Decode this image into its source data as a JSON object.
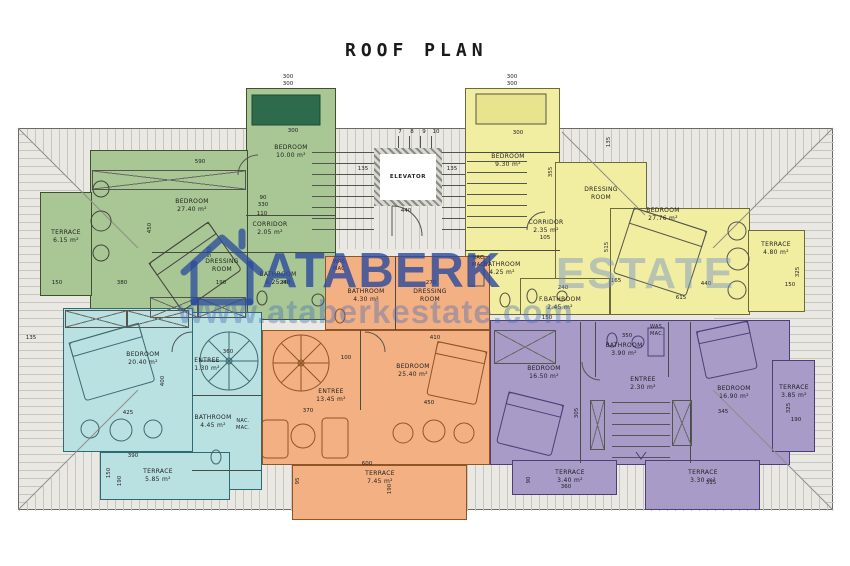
{
  "title": "ROOF PLAN",
  "watermark": {
    "brand": "ATABERK",
    "suffix": "ESTATE",
    "url": "www.ataberkestate.com"
  },
  "core": {
    "elevator": "ELEVATOR",
    "stairs": [
      "7",
      "8",
      "9",
      "10"
    ],
    "dims": {
      "l135": "135",
      "r135": "135",
      "w440": "440"
    }
  },
  "roof": {
    "dims": {
      "l135": "135"
    }
  },
  "units": {
    "green": {
      "rooms": {
        "terrace": {
          "name": "TERRACE",
          "area": "6.15 m²"
        },
        "bedroom_main": {
          "name": "BEDROOM",
          "area": "27.40 m²"
        },
        "bedroom_top": {
          "name": "BEDROOM",
          "area": "10.00 m²"
        },
        "dressing": {
          "name": "DRESSING ROOM",
          "area": ""
        },
        "corridor": {
          "name": "CORRIDOR",
          "area": "2.05 m²"
        },
        "bathroom": {
          "name": "BATHROOM",
          "area": "6.25 m²"
        }
      },
      "dims": {
        "d590": "590",
        "top300a": "300",
        "top300b": "300",
        "bed300": "300",
        "d450": "450",
        "d530": "530",
        "d110": "110",
        "d150": "150",
        "d380": "380",
        "d190": "190",
        "d240": "240",
        "d90": "90",
        "d330": "330"
      }
    },
    "yellow": {
      "rooms": {
        "bedroom_top": {
          "name": "BEDROOM",
          "area": "9.30 m²"
        },
        "dressing": {
          "name": "DRESSING ROOM",
          "area": ""
        },
        "corridor": {
          "name": "CORRIDOR",
          "area": "2.35 m²"
        },
        "bathroom": {
          "name": "BATHROOM",
          "area": "4.25 m²"
        },
        "wash": {
          "name": "NAC. MAC.",
          "area": ""
        },
        "f_bathroom": {
          "name": "F.BATHROOM",
          "area": "2.45 m²"
        },
        "bedroom_main": {
          "name": "BEDROOM",
          "area": "27.76 m²"
        },
        "terrace": {
          "name": "TERRACE",
          "area": "4.80 m²"
        }
      },
      "dims": {
        "top300a": "300",
        "top300b": "300",
        "bed300": "300",
        "d355": "355",
        "d135": "135",
        "d515": "515",
        "d165": "165",
        "d240": "240",
        "d615": "615",
        "d440": "440",
        "d325": "325",
        "d150": "150",
        "d105": "105"
      }
    },
    "cyan": {
      "rooms": {
        "bedroom": {
          "name": "BEDROOM",
          "area": "20.40 m²"
        },
        "entree": {
          "name": "ENTREE",
          "area": "1.30 m²"
        },
        "bathroom": {
          "name": "BATHROOM",
          "area": "4.45 m²"
        },
        "wash": {
          "name": "NAC. MAC.",
          "area": ""
        },
        "terrace": {
          "name": "TERRACE",
          "area": "5.85 m²"
        }
      },
      "dims": {
        "d360": "360",
        "d425": "425",
        "d400": "400",
        "d390": "390",
        "d150": "150",
        "d190": "190"
      }
    },
    "orange": {
      "rooms": {
        "entree": {
          "name": "ENTREE",
          "area": "13.45 m²"
        },
        "bedroom": {
          "name": "BEDROOM",
          "area": "25.40 m²"
        },
        "bathroom": {
          "name": "BATHROOM",
          "area": "4.30 m²"
        },
        "wash": {
          "name": "WAS. MAC.",
          "area": ""
        },
        "dressing": {
          "name": "DRESSING ROOM",
          "area": ""
        },
        "terrace": {
          "name": "TERRACE",
          "area": "7.45 m²"
        }
      },
      "dims": {
        "d100": "100",
        "d410": "410",
        "d450": "450",
        "d370": "370",
        "d600": "600",
        "d270": "270",
        "d95": "95",
        "d190": "190"
      }
    },
    "purple": {
      "rooms": {
        "bedroom_left": {
          "name": "BEDROOM",
          "area": "16.50 m²"
        },
        "bathroom": {
          "name": "BATHROOM",
          "area": "3.90 m²"
        },
        "wash": {
          "name": "WAS. MAC.",
          "area": ""
        },
        "entree": {
          "name": "ENTREE",
          "area": "2.30 m²"
        },
        "bedroom_right": {
          "name": "BEDROOM",
          "area": "16.90 m²"
        },
        "terrace_left": {
          "name": "TERRACE",
          "area": "3.40 m²"
        },
        "terrace_right": {
          "name": "TERRACE",
          "area": "3.30 m²"
        },
        "terrace_east": {
          "name": "TERRACE",
          "area": "3.85 m²"
        }
      },
      "dims": {
        "d350": "350",
        "d345": "345",
        "d315": "315",
        "d360": "360",
        "d325": "325",
        "d190": "190",
        "d305": "305",
        "d150": "150",
        "d90": "90"
      }
    }
  }
}
